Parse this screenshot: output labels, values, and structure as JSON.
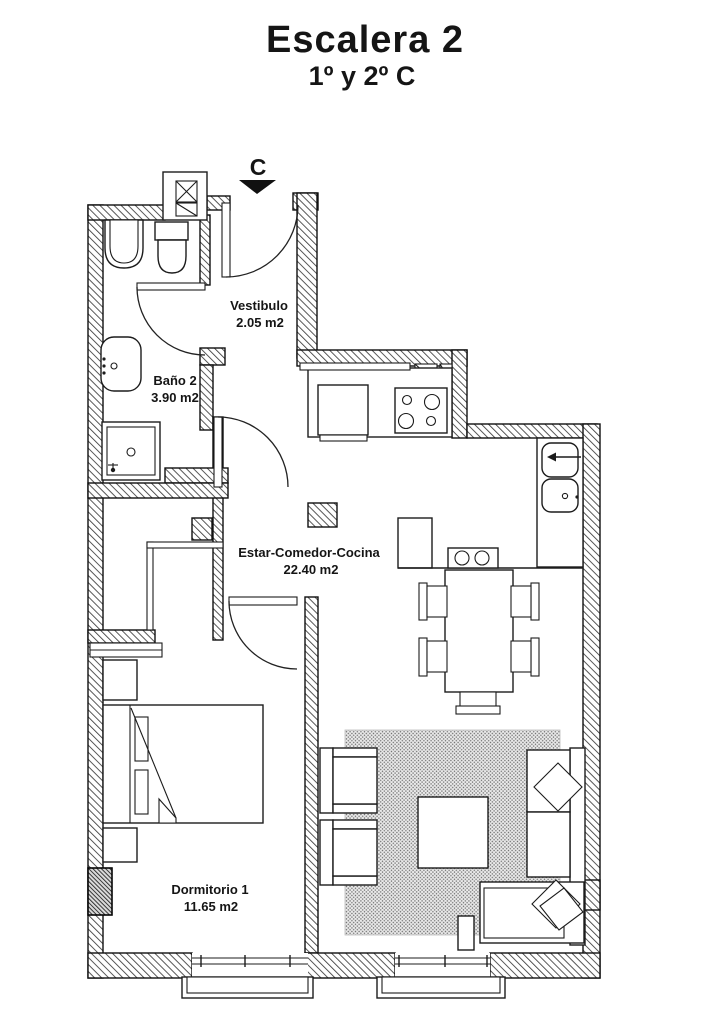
{
  "header": {
    "title": "Escalera 2",
    "subtitle": "1º y 2º C"
  },
  "compass": {
    "label": "C"
  },
  "rooms": {
    "vestibulo": {
      "name": "Vestibulo",
      "area": "2.05 m2"
    },
    "bano": {
      "name": "Baño 2",
      "area": "3.90 m2"
    },
    "estar": {
      "name": "Estar-Comedor-Cocina",
      "area": "22.40 m2"
    },
    "dormitorio": {
      "name": "Dormitorio 1",
      "area": "11.65 m2"
    }
  },
  "colors": {
    "ink": "#151515",
    "paper": "#ffffff",
    "wall_hatch": "#3a3a3a",
    "rug_fill": "#ebebeb",
    "rug_dot": "#6f6f6f"
  }
}
